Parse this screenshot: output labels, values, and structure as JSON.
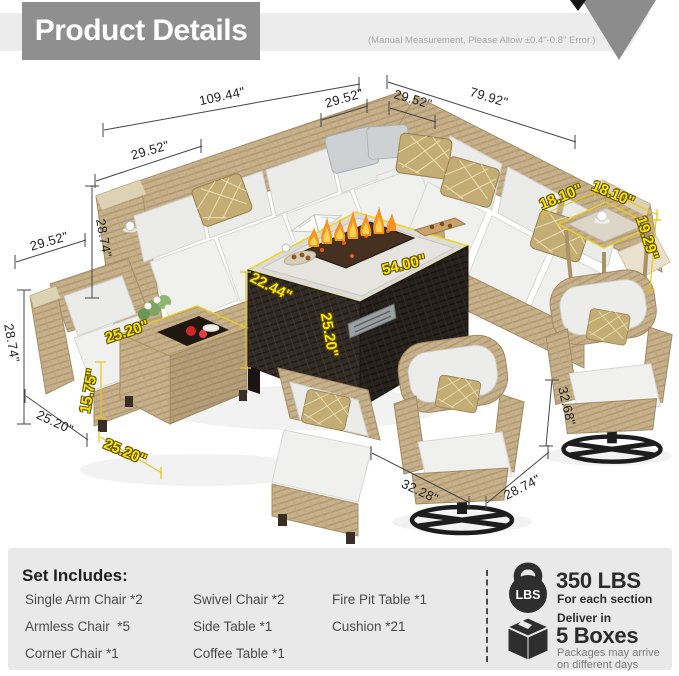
{
  "header": {
    "title": "Product Details",
    "note": "(Manual Measurement, Please Allow ±0.4\"-0.8\" Error.)"
  },
  "dims": {
    "sofa_back_left": "109.44\"",
    "corner_seat_left": "29.52\"",
    "corner_seat_right": "29.52\"",
    "sofa_back_right": "79.92\"",
    "armchair_top_width": "29.52\"",
    "armchair_top_height": "28.74\"",
    "armchair_side_width": "29.52\"",
    "armchair_side_height": "28.74\"",
    "armchair_side_depth": "25.20\"",
    "swivel_width": "32.28\"",
    "swivel_depth": "28.74\"",
    "swivel_height": "32.68\"",
    "firepit_depth": "22.44\"",
    "firepit_width": "54.00\"",
    "firepit_height": "25.20\"",
    "sidetable_depth": "18.10\"",
    "sidetable_width": "18.10\"",
    "sidetable_height": "19.29\"",
    "coffeetable_top": "25.20\"",
    "coffeetable_height": "15.75\"",
    "coffeetable_width": "25.20\""
  },
  "set_includes": {
    "heading": "Set Includes:",
    "columns": [
      [
        "Single Arm Chair *2",
        "Armless Chair  *5",
        "Corner Chair *1"
      ],
      [
        "Swivel Chair *2",
        "Side Table *1",
        "Coffee Table *1"
      ],
      [
        "Fire Pit Table *1",
        "Cushion *21"
      ]
    ]
  },
  "info": {
    "weight": {
      "icon_label": "LBS",
      "value": "350 LBS",
      "caption": "For each section"
    },
    "delivery": {
      "intro": "Deliver in",
      "value": "5 Boxes",
      "caption_line1": "Packages may arrive",
      "caption_line2": "on different days"
    }
  },
  "colors": {
    "accent_yellow": "#ffe10a",
    "wicker": "#c7b08c",
    "cushion": "#ededeb",
    "fire_table_body": "#2d2823",
    "flame": "#f59222",
    "header_gray": "#8f8f8f"
  }
}
